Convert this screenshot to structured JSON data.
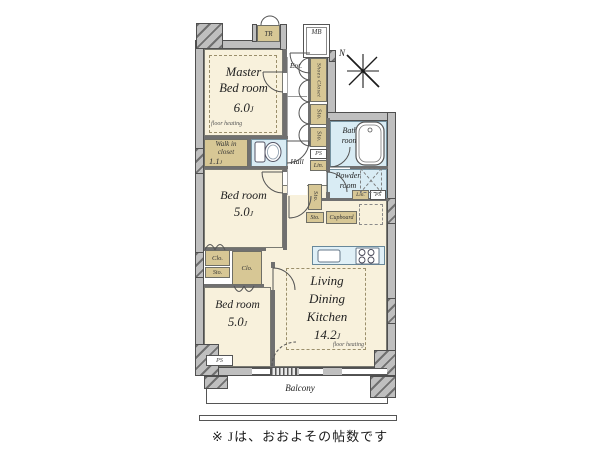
{
  "caption": "※ Jは、おおよその帖数です",
  "compass": {
    "north": "N"
  },
  "colors": {
    "room_cream": "#f8f1dc",
    "closet_tan": "#d7c795",
    "water_blue": "#d9ecf4",
    "wall_gray": "#bfbfbf",
    "outline": "#4f4f4f"
  },
  "rooms": {
    "master_bedroom": {
      "line1": "Master",
      "line2": "Bed room",
      "size": "6.0",
      "unit": "J",
      "note": "floor heating"
    },
    "walk_in_closet": {
      "line1": "Walk in",
      "line2": "closet",
      "size": "1.1",
      "unit": "J"
    },
    "bedroom_2": {
      "name": "Bed room",
      "size": "5.0",
      "unit": "J"
    },
    "bedroom_3": {
      "name": "Bed room",
      "size": "5.0",
      "unit": "J"
    },
    "ldk": {
      "line1": "Living",
      "line2": "Dining",
      "line3": "Kitchen",
      "size": "14.2",
      "unit": "J",
      "note": "floor heating"
    },
    "bathroom": {
      "line1": "Bath",
      "line2": "room"
    },
    "powder_room": {
      "line1": "Powder",
      "line2": "room"
    },
    "hall": {
      "name": "Hall"
    },
    "entrance": {
      "name": "Ent."
    },
    "balcony": {
      "name": "Balcony"
    }
  },
  "labels": {
    "tr": "TR",
    "mb": "MB",
    "shoes_closet": "Shoes Closet",
    "sto": "Sto.",
    "clo": "Clo.",
    "ps": "PS",
    "lin": "Lin.",
    "cupboard": "Cupboard"
  }
}
